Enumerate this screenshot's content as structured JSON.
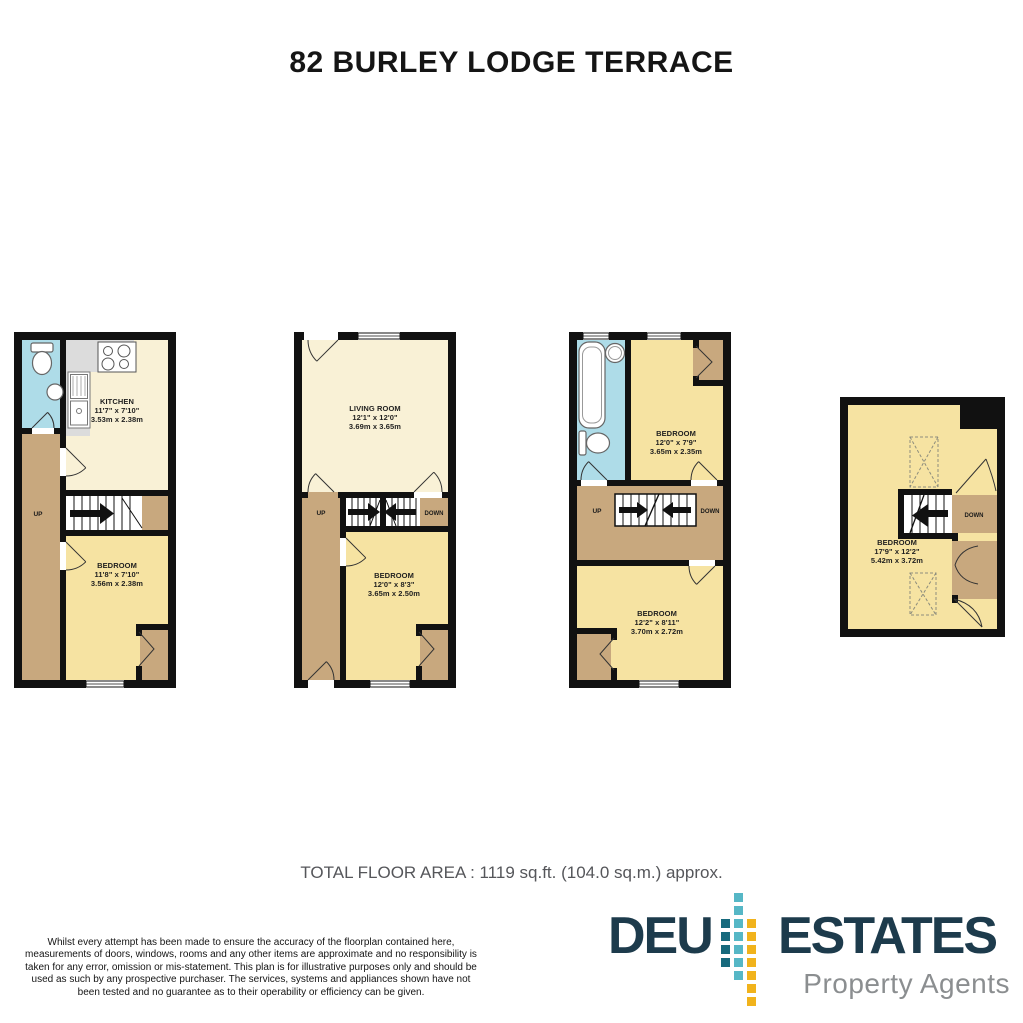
{
  "title": "82 BURLEY LODGE TERRACE",
  "total_area": "TOTAL FLOOR AREA : 1119 sq.ft. (104.0 sq.m.) approx.",
  "disclaimer": "Whilst every attempt has been made to ensure the accuracy of the floorplan contained here, measurements of doors, windows, rooms and any other items are approximate and no responsibility is taken for any error, omission or mis-statement. This plan is for illustrative purposes only and should be used as such by any prospective purchaser. The services, systems and appliances shown have not been tested and no guarantee as to their operability or efficiency can be given.",
  "colors": {
    "wall": "#111111",
    "bedroom_fill": "#f6e3a2",
    "living_fill": "#f9f1d6",
    "hall_fill": "#c8a87e",
    "bath_fill": "#aedce8",
    "counter_fill": "#dcdcdc",
    "logo_navy": "#1d3b4c",
    "logo_teal_dark": "#176a7d",
    "logo_teal_light": "#56b7c6",
    "logo_yellow": "#f1b31c",
    "logo_gray": "#8b8e90"
  },
  "floors": [
    {
      "id": "ground-floor",
      "rooms": [
        {
          "name": "KITCHEN",
          "imperial": "11'7\" x 7'10\"",
          "metric": "3.53m x 2.38m"
        },
        {
          "name": "BEDROOM",
          "imperial": "11'8\" x 7'10\"",
          "metric": "3.56m x 2.38m"
        }
      ],
      "stairs": {
        "up": "UP"
      }
    },
    {
      "id": "first-floor",
      "rooms": [
        {
          "name": "LIVING ROOM",
          "imperial": "12'1\" x 12'0\"",
          "metric": "3.69m x 3.65m"
        },
        {
          "name": "BEDROOM",
          "imperial": "12'0\" x 8'3\"",
          "metric": "3.65m x 2.50m"
        }
      ],
      "stairs": {
        "up": "UP",
        "down": "DOWN"
      }
    },
    {
      "id": "second-floor",
      "rooms": [
        {
          "name": "BEDROOM",
          "imperial": "12'0\" x 7'9\"",
          "metric": "3.65m x 2.35m"
        },
        {
          "name": "BEDROOM",
          "imperial": "12'2\" x 8'11\"",
          "metric": "3.70m x 2.72m"
        }
      ],
      "stairs": {
        "up": "UP",
        "down": "DOWN"
      }
    },
    {
      "id": "attic",
      "rooms": [
        {
          "name": "BEDROOM",
          "imperial": "17'9\" x 12'2\"",
          "metric": "5.42m x 3.72m"
        }
      ],
      "stairs": {
        "down": "DOWN"
      }
    }
  ],
  "logo": {
    "word1": "DEU",
    "word2": "ESTATES",
    "tagline": "Property Agents",
    "squares": [
      [
        0,
        2,
        "logo_teal_dark"
      ],
      [
        0,
        3,
        "logo_teal_dark"
      ],
      [
        0,
        4,
        "logo_teal_dark"
      ],
      [
        0,
        5,
        "logo_teal_dark"
      ],
      [
        1,
        0,
        "logo_teal_light"
      ],
      [
        1,
        1,
        "logo_teal_light"
      ],
      [
        1,
        2,
        "logo_teal_light"
      ],
      [
        1,
        3,
        "logo_teal_light"
      ],
      [
        1,
        4,
        "logo_teal_light"
      ],
      [
        1,
        5,
        "logo_teal_light"
      ],
      [
        1,
        6,
        "logo_teal_light"
      ],
      [
        2,
        2,
        "logo_yellow"
      ],
      [
        2,
        3,
        "logo_yellow"
      ],
      [
        2,
        4,
        "logo_yellow"
      ],
      [
        2,
        5,
        "logo_yellow"
      ],
      [
        2,
        6,
        "logo_yellow"
      ],
      [
        2,
        7,
        "logo_yellow"
      ],
      [
        2,
        8,
        "logo_yellow"
      ]
    ]
  }
}
